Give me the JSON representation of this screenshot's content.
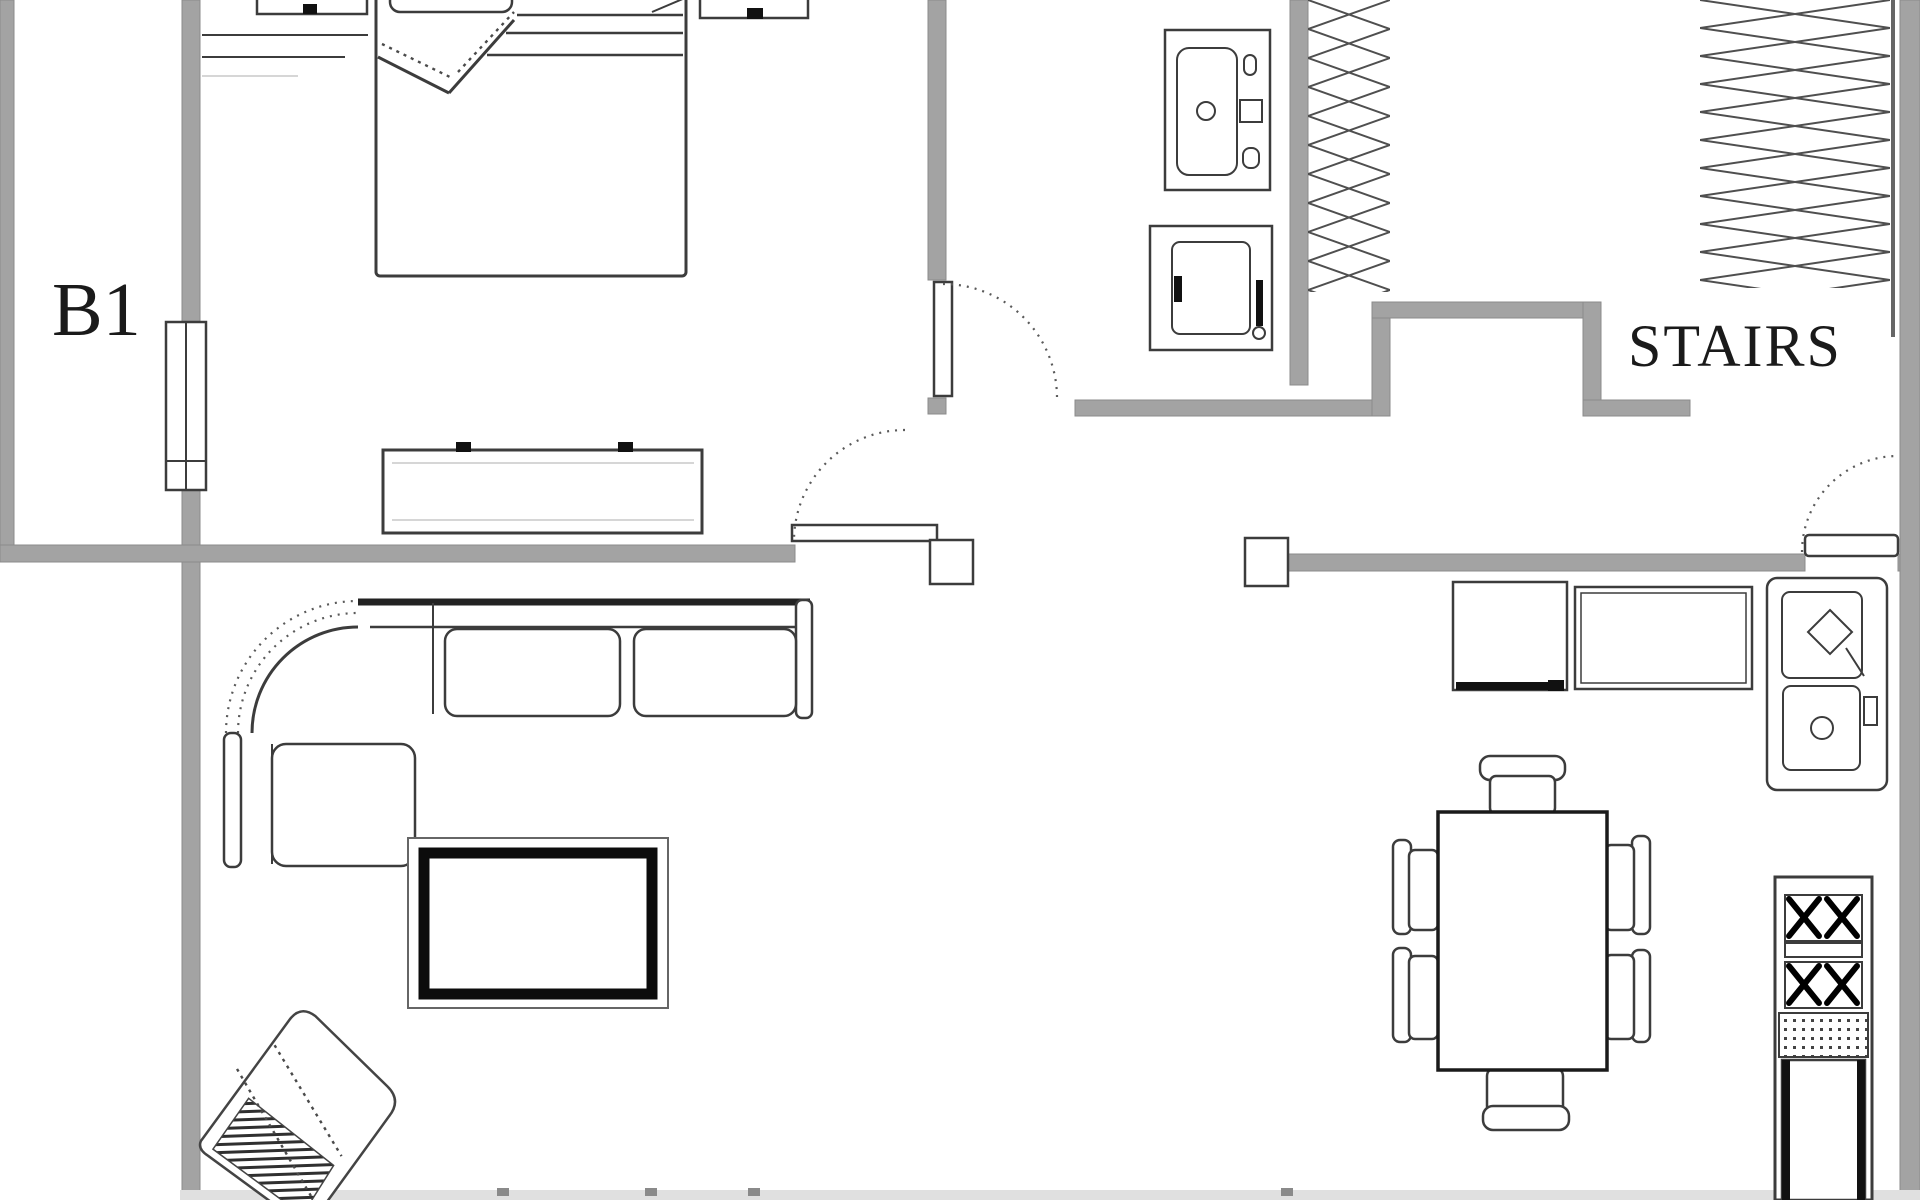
{
  "meta": {
    "type": "architectural-floor-plan",
    "view": "top-down",
    "level_label_visible": true
  },
  "labels": {
    "area": "B1",
    "stairs": "STAIRS"
  },
  "colors": {
    "wall": "#a3a3a3",
    "wall_edge": "#8b8b8b",
    "line": "#3c3c3c",
    "line_dark": "#141414",
    "background": "#ffffff"
  },
  "rooms": [
    {
      "name": "bedroom",
      "objects": [
        "double-bed",
        "pillow",
        "folded-blanket",
        "nightstand-left",
        "nightstand-right",
        "radiator",
        "dresser",
        "window",
        "door-swing"
      ]
    },
    {
      "name": "vestibule-bath",
      "objects": [
        "sink-vanity",
        "washing-machine"
      ]
    },
    {
      "name": "stair-hall",
      "objects": [
        "closet-hangers-left",
        "closet-hangers-right",
        "stair-landing-notch",
        "door-swing-right"
      ]
    },
    {
      "name": "living-room",
      "objects": [
        "sectional-sofa",
        "coffee-table",
        "speaker-armchair",
        "door-with-swing"
      ]
    },
    {
      "name": "kitchen-dining",
      "objects": [
        "base-cabinet",
        "counter-unit",
        "double-basin-sink",
        "stove-two-burner-groups",
        "dining-table",
        "six-chairs"
      ]
    }
  ]
}
